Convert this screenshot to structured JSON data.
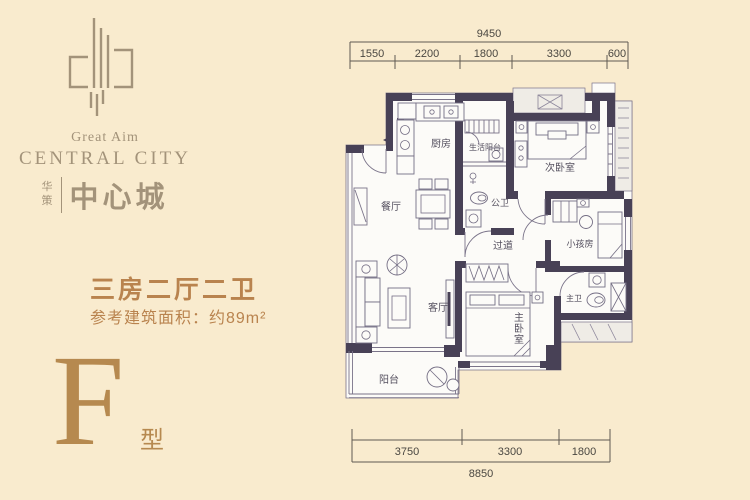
{
  "brand": {
    "tagline_en": "Great Aim",
    "name_en": "CENTRAL CITY",
    "prefix_cn": "华策",
    "name_cn": "中心城"
  },
  "unit": {
    "layout_title": "三房二厅二卫",
    "area_note": "参考建筑面积：约89m²",
    "type_letter": "F",
    "type_suffix": "型"
  },
  "floorplan": {
    "rooms": [
      {
        "id": "kitchen",
        "label": "厨房"
      },
      {
        "id": "service-balcony",
        "label": "生活阳台"
      },
      {
        "id": "second-bedroom",
        "label": "次卧室"
      },
      {
        "id": "dining-room",
        "label": "餐厅"
      },
      {
        "id": "public-bathroom",
        "label": "公卫"
      },
      {
        "id": "corridor",
        "label": "过道"
      },
      {
        "id": "kids-room",
        "label": "小孩房"
      },
      {
        "id": "living-room",
        "label": "客厅"
      },
      {
        "id": "master-bedroom",
        "label": "主卧室"
      },
      {
        "id": "master-bathroom",
        "label": "主卫"
      },
      {
        "id": "balcony",
        "label": "阳台"
      }
    ],
    "dimensions": {
      "top_total": "9450",
      "top_segments": [
        "1550",
        "2200",
        "1800",
        "3300",
        "600"
      ],
      "bottom_segments": [
        "3750",
        "3300",
        "1800"
      ],
      "bottom_total": "8850"
    }
  },
  "colors": {
    "background": "#f9ebce",
    "brand_gold": "#a3937a",
    "accent_gold": "#b9834e",
    "wall": "#484156"
  }
}
